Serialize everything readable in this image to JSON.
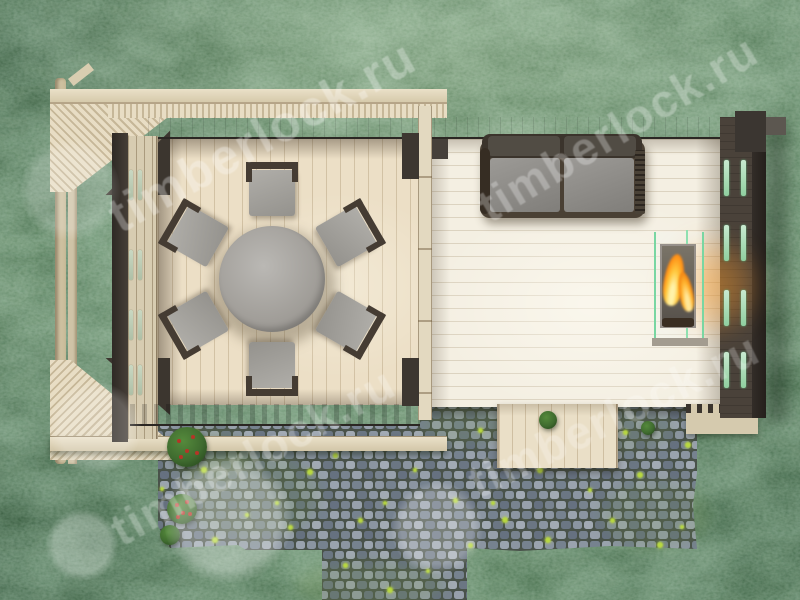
{
  "meta": {
    "image_type": "3d-architectural-render",
    "view": "top-down",
    "subject": "garden pavilion with pergola, round dining table with six chairs, sofa, bio-fireplace, cobblestone patio and lawn"
  },
  "watermark": {
    "text": "timberlock.ru",
    "instances": [
      {
        "x": 262,
        "y": 136,
        "rot": -29,
        "size": 50,
        "opacity": 0.3
      },
      {
        "x": 618,
        "y": 128,
        "rot": -31,
        "size": 46,
        "opacity": 0.28
      },
      {
        "x": 253,
        "y": 456,
        "rot": -29,
        "size": 46,
        "opacity": 0.26
      },
      {
        "x": 614,
        "y": 415,
        "rot": -26,
        "size": 46,
        "opacity": 0.24
      }
    ],
    "logo_circles": [
      {
        "x": 70,
        "y": 190,
        "r": 50,
        "opacity": 0.2
      },
      {
        "x": 95,
        "y": 428,
        "r": 46,
        "opacity": 0.2
      },
      {
        "x": 82,
        "y": 545,
        "r": 36,
        "opacity": 0.26
      },
      {
        "x": 228,
        "y": 520,
        "r": 64,
        "opacity": 0.3
      },
      {
        "x": 437,
        "y": 528,
        "r": 46,
        "opacity": 0.26
      }
    ]
  },
  "palette": {
    "grass_base": "#54805a",
    "grass_dark": "#31543b",
    "grass_light": "#79a377",
    "wood_light": "#e9dec6",
    "wood_beam": "#e0d5ba",
    "wood_dark_wall": "#46403a",
    "wood_edge_dark": "#322c27",
    "floor_pergola": "#ecdfc6",
    "floor_cabin": "#f4efe2",
    "pavement_grout": "#49524a",
    "stone_light": "#a2aab4",
    "stone_mid": "#828c99",
    "stone_dark": "#636e7c",
    "moss": "#b8d83f",
    "bush_green": "#3f6b2f",
    "flower_red": "#b53527",
    "cushion_gray": "#908e8a",
    "table_gray": "#a8a5a0",
    "chair_frame": "#453c33",
    "flame": "#ff9420",
    "flame_core": "#ffe27a",
    "glass_green": "#7fd8a6"
  },
  "scene": {
    "table": {
      "cx": 272,
      "cy": 279,
      "r": 53
    },
    "chairs": {
      "radius": 88,
      "angles": [
        -90,
        -30,
        30,
        90,
        150,
        210
      ],
      "w": 52,
      "h": 58
    },
    "left_wall_slots": {
      "cols": [
        129,
        138
      ],
      "w": 4,
      "h": 30,
      "ys": [
        170,
        250,
        310,
        365
      ]
    },
    "right_wall_slots": {
      "cols": [
        724,
        741
      ],
      "w": 5,
      "h": 36,
      "ys": [
        160,
        225,
        290,
        352
      ]
    },
    "moss_dots": [
      [
        196,
        432
      ],
      [
        204,
        470
      ],
      [
        162,
        489
      ],
      [
        247,
        515
      ],
      [
        215,
        540
      ],
      [
        277,
        503
      ],
      [
        290,
        527
      ],
      [
        310,
        472
      ],
      [
        335,
        455
      ],
      [
        345,
        565
      ],
      [
        360,
        520
      ],
      [
        385,
        503
      ],
      [
        390,
        590
      ],
      [
        415,
        470
      ],
      [
        428,
        571
      ],
      [
        455,
        500
      ],
      [
        470,
        545
      ],
      [
        480,
        430
      ],
      [
        493,
        503
      ],
      [
        505,
        520
      ],
      [
        540,
        470
      ],
      [
        548,
        540
      ],
      [
        565,
        447
      ],
      [
        590,
        490
      ],
      [
        612,
        520
      ],
      [
        625,
        432
      ],
      [
        640,
        475
      ],
      [
        660,
        545
      ],
      [
        682,
        527
      ],
      [
        688,
        445
      ]
    ],
    "bushes": [
      {
        "x": 187,
        "y": 447,
        "r": 20,
        "flowers": true
      },
      {
        "x": 182,
        "y": 509,
        "r": 15,
        "flowers": true
      },
      {
        "x": 548,
        "y": 420,
        "r": 9,
        "flowers": false
      },
      {
        "x": 648,
        "y": 428,
        "r": 7,
        "flowers": false
      },
      {
        "x": 170,
        "y": 535,
        "r": 10,
        "flowers": false
      }
    ],
    "tint_patches": [
      [
        250,
        495,
        140,
        90,
        0.22
      ],
      [
        585,
        430,
        180,
        50,
        0.18
      ],
      [
        655,
        515,
        110,
        70,
        0.2
      ],
      [
        370,
        585,
        150,
        50,
        0.25
      ],
      [
        465,
        425,
        90,
        40,
        0.2
      ],
      [
        210,
        455,
        80,
        50,
        0.25
      ]
    ]
  }
}
